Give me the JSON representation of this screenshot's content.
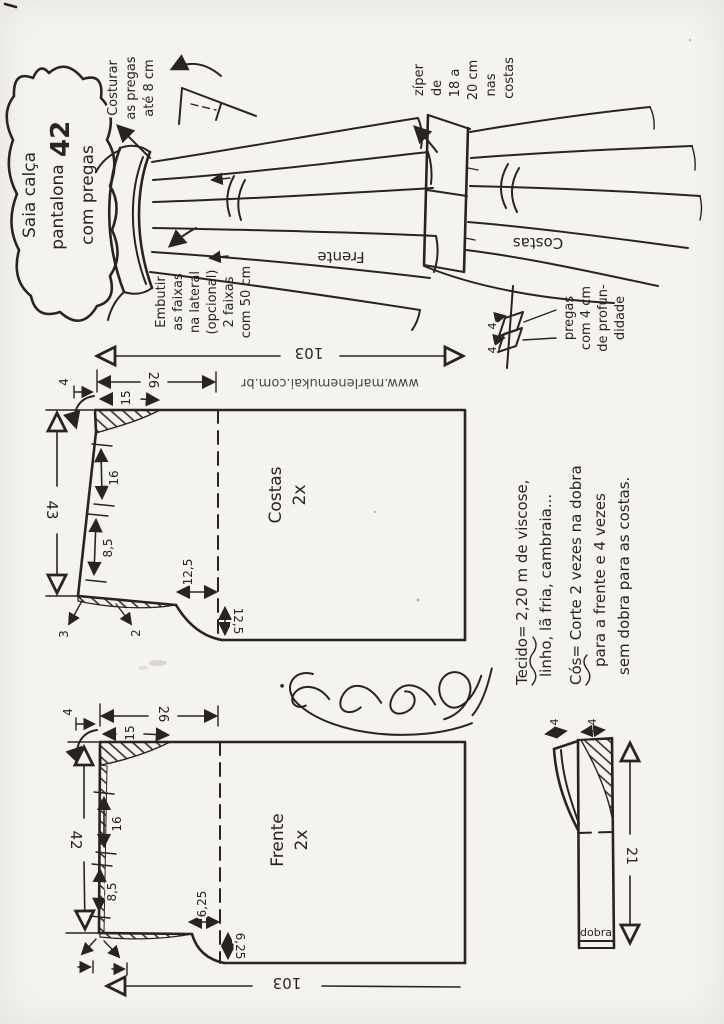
{
  "scan": {
    "paper_color": "#f4f3ef",
    "ink_color": "#29241f",
    "watermark": "www.marlenemukai.com.br"
  },
  "title": {
    "line1": "Saia calça",
    "line2": "pantalona",
    "line3": "com pregas",
    "size": "42"
  },
  "notes": {
    "sew_pleats": {
      "l1": "Costurar",
      "l2": "as pregas",
      "l3": "até 8 cm"
    },
    "zipper": {
      "l1": "zíper",
      "l2": "de",
      "l3": "18 a",
      "l4": "20 cm",
      "l5": "nas",
      "l6": "costas"
    },
    "bands": {
      "l1": "Embutir",
      "l2": "as faixas",
      "l3": "na lateral",
      "l4": "(opcional)",
      "l5": "2 faixas",
      "l6": "com 50 cm"
    },
    "pleat_depth": {
      "l1": "pregas",
      "l2": "com 4 cm",
      "l3": "de profun-",
      "l4": "didade",
      "d1": "4",
      "d2": "4"
    },
    "front": "Frente",
    "back": "Costas"
  },
  "fabric": {
    "l1": "Tecido= 2,20 m de viscose,",
    "l2": "linho, lã fria, cambraia...",
    "l3": "Cós= Corte 2 vezes na dobra",
    "l4": "para a frente e 4 vezes",
    "l5": "sem dobra para as costas."
  },
  "costas": {
    "name": "Costas",
    "cut": "2x",
    "width": "103",
    "to_fold": "26",
    "dart": "15",
    "ext": "4",
    "length": "43",
    "mark1": "16",
    "mark2": "8,5",
    "crotch_w": "12,5",
    "crotch_d": "12,5",
    "sa_a": "3",
    "sa_b": "2"
  },
  "frente": {
    "name": "Frente",
    "cut": "2x",
    "width": "103",
    "to_fold": "26",
    "dart": "15",
    "ext": "4",
    "length": "42",
    "mark1": "16",
    "mark2": "8,5",
    "crotch_w": "6,25",
    "crotch_d": "6,25"
  },
  "waistband": {
    "length": "21",
    "w1": "4",
    "w2": "4",
    "fold": "dobra"
  }
}
